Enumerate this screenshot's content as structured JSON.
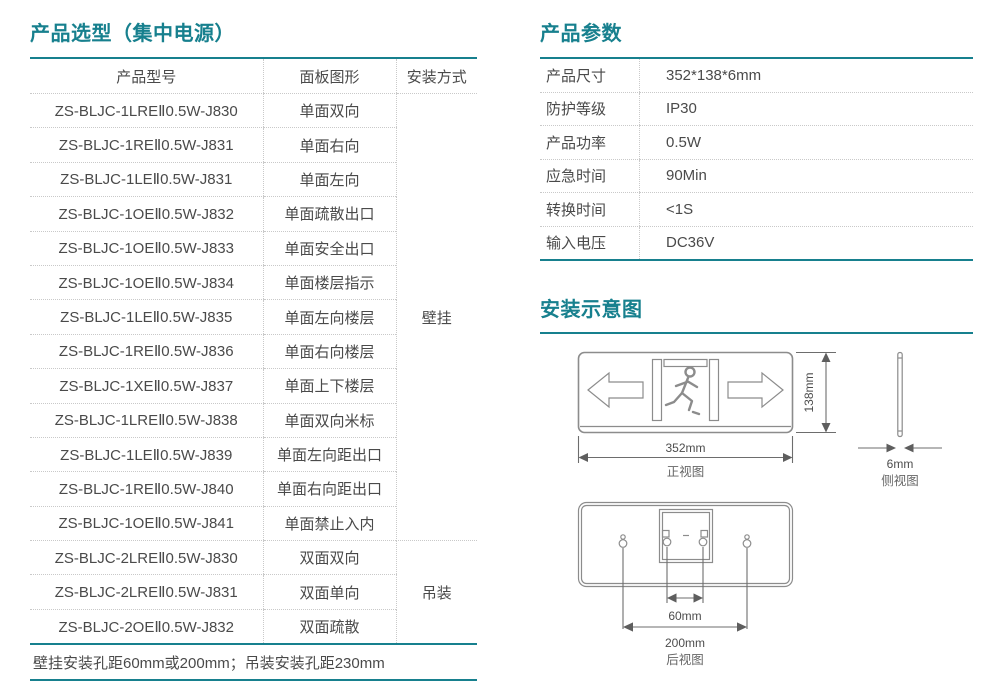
{
  "colors": {
    "accent": "#17808E",
    "body_text": "#4A4A4A",
    "diagram_line": "#8C8C8C",
    "dotted_rule": "#C9C9C9"
  },
  "selection": {
    "title": "产品选型（集中电源）",
    "columns": [
      "产品型号",
      "面板图形",
      "安装方式"
    ],
    "groups": [
      {
        "mount": "壁挂",
        "rows": [
          [
            "ZS-BLJC-1LREⅡ0.5W-J830",
            "单面双向"
          ],
          [
            "ZS-BLJC-1REⅡ0.5W-J831",
            "单面右向"
          ],
          [
            "ZS-BLJC-1LEⅡ0.5W-J831",
            "单面左向"
          ],
          [
            "ZS-BLJC-1OEⅡ0.5W-J832",
            "单面疏散出口"
          ],
          [
            "ZS-BLJC-1OEⅡ0.5W-J833",
            "单面安全出口"
          ],
          [
            "ZS-BLJC-1OEⅡ0.5W-J834",
            "单面楼层指示"
          ],
          [
            "ZS-BLJC-1LEⅡ0.5W-J835",
            "单面左向楼层"
          ],
          [
            "ZS-BLJC-1REⅡ0.5W-J836",
            "单面右向楼层"
          ],
          [
            "ZS-BLJC-1XEⅡ0.5W-J837",
            "单面上下楼层"
          ],
          [
            "ZS-BLJC-1LREⅡ0.5W-J838",
            "单面双向米标"
          ],
          [
            "ZS-BLJC-1LEⅡ0.5W-J839",
            "单面左向距出口"
          ],
          [
            "ZS-BLJC-1REⅡ0.5W-J840",
            "单面右向距出口"
          ],
          [
            "ZS-BLJC-1OEⅡ0.5W-J841",
            "单面禁止入内"
          ]
        ]
      },
      {
        "mount": "吊装",
        "rows": [
          [
            "ZS-BLJC-2LREⅡ0.5W-J830",
            "双面双向"
          ],
          [
            "ZS-BLJC-2LREⅡ0.5W-J831",
            "双面单向"
          ],
          [
            "ZS-BLJC-2OEⅡ0.5W-J832",
            "双面疏散"
          ]
        ]
      }
    ],
    "footnote": "壁挂安装孔距60mm或200mm；吊装安装孔距230mm"
  },
  "parameters": {
    "title": "产品参数",
    "rows": [
      {
        "label": "产品尺寸",
        "value": "352*138*6mm"
      },
      {
        "label": "防护等级",
        "value": "IP30"
      },
      {
        "label": "产品功率",
        "value": "0.5W"
      },
      {
        "label": "应急时间",
        "value": "90Min"
      },
      {
        "label": "转换时间",
        "value": "<1S"
      },
      {
        "label": "输入电压",
        "value": "DC36V"
      }
    ]
  },
  "installation": {
    "title": "安装示意图",
    "front_view": {
      "label": "正视图",
      "width": "352mm",
      "height": "138mm"
    },
    "side_view": {
      "label": "侧视图",
      "thickness": "6mm"
    },
    "rear_view": {
      "label": "后视图",
      "inner_hole_pitch": "60mm",
      "outer_hole_pitch": "200mm"
    }
  }
}
